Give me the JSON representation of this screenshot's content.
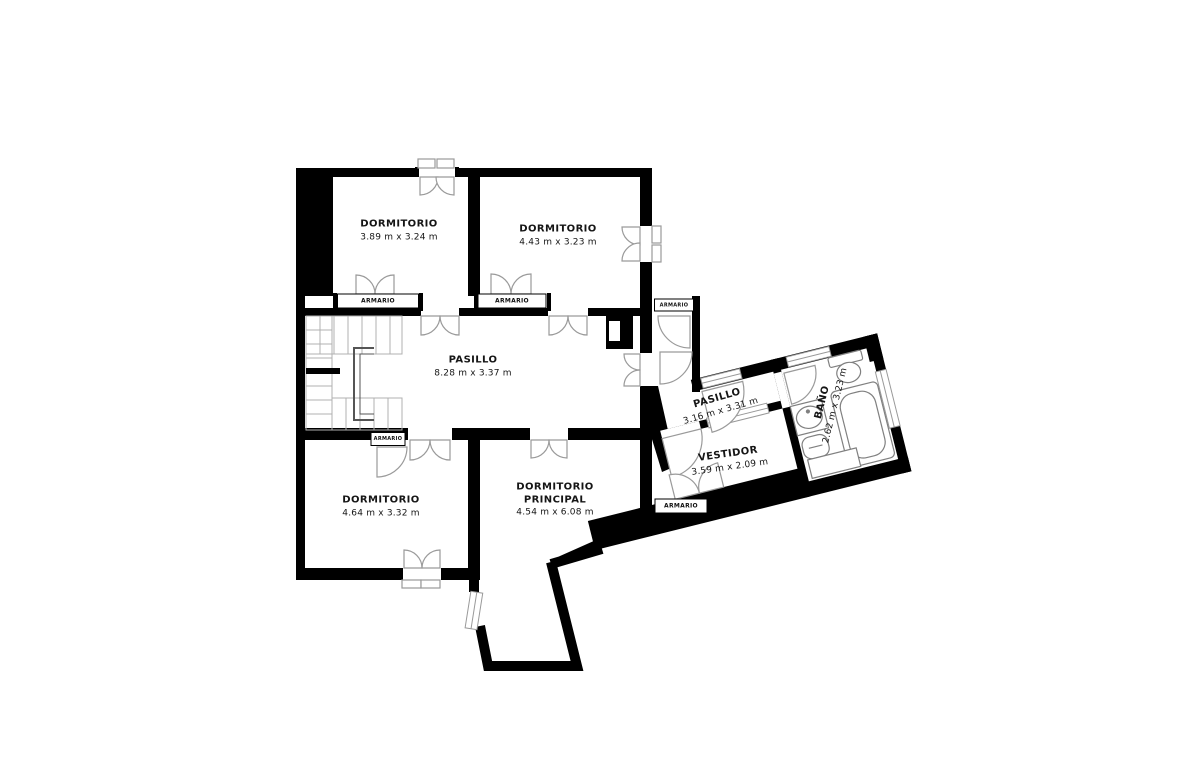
{
  "plan_title": "Planta - plano de vivienda",
  "labels": {
    "closet": "ARMARIO"
  },
  "rooms": {
    "bedroom1": {
      "name": "DORMITORIO",
      "dims": "3.89 m x 3.24 m"
    },
    "bedroom2": {
      "name": "DORMITORIO",
      "dims": "4.43 m x 3.23 m"
    },
    "hallway": {
      "name": "PASILLO",
      "dims": "8.28 m x 3.37 m"
    },
    "hallway2": {
      "name": "PASILLO",
      "dims": "3.16 m x 3.31 m"
    },
    "bathroom": {
      "name": "BAÑO",
      "dims": "2.62 m x 3.23 m"
    },
    "dressing": {
      "name": "VESTIDOR",
      "dims": "3.59 m x 2.09 m"
    },
    "bedroom3": {
      "name": "DORMITORIO",
      "dims": "4.64 m x 3.32 m"
    },
    "master": {
      "name": "DORMITORIO PRINCIPAL",
      "dims": "4.54 m x 6.08 m"
    }
  },
  "colors": {
    "wall": "#000000",
    "door_arc": "#9a9a9a",
    "fixture": "#808080",
    "stairs": "#aaaaaa",
    "background": "#ffffff"
  }
}
